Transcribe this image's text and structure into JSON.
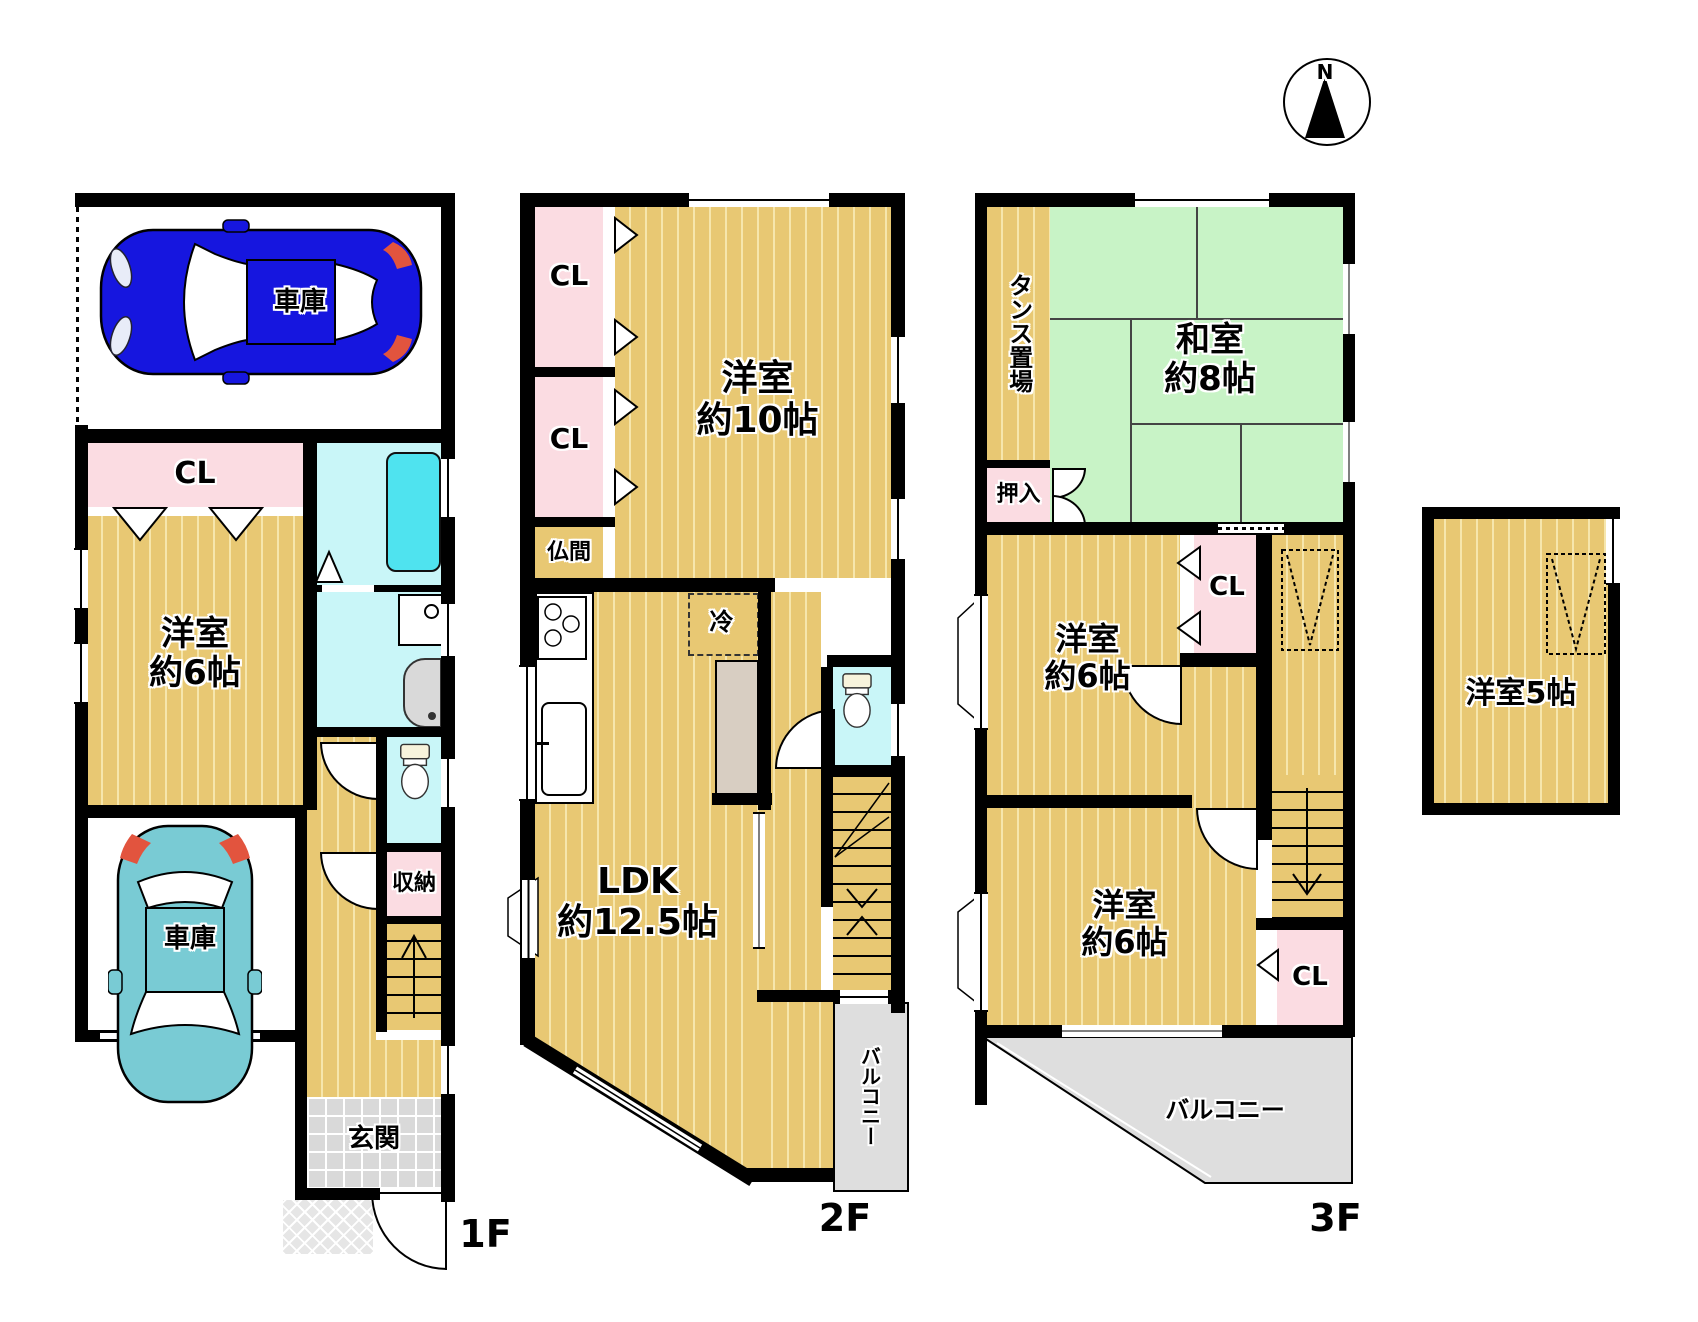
{
  "compass": {
    "north": "N"
  },
  "floor1": {
    "label": "1F",
    "garage_upper": "車庫",
    "garage_lower": "車庫",
    "closet": "CL",
    "western_room": "洋室\n約6帖",
    "storage": "収納",
    "entrance": "玄関"
  },
  "floor2": {
    "label": "2F",
    "closet_upper": "CL",
    "closet_lower": "CL",
    "butsuma": "仏間",
    "western_room": "洋室\n約10帖",
    "refrigerator": "冷",
    "ldk": "LDK\n約12.5帖",
    "balcony": "バルコニー"
  },
  "floor3": {
    "label": "3F",
    "tansu_space": "タンス置場",
    "japanese_room": "和室\n約8帖",
    "oshiire": "押入",
    "closet_a": "CL",
    "western_room_upper": "洋室\n約6帖",
    "western_room_lower": "洋室\n約6帖",
    "closet_b": "CL",
    "balcony": "バルコニー"
  },
  "annex": {
    "western_room": "洋室5帖"
  },
  "colors": {
    "wall": "#000000",
    "wood_floor": "#e8c873",
    "tatami_green": "#c8f3c6",
    "closet_pink": "#fbdce2",
    "wet_area_cyan": "#c9f6f8",
    "bathtub_cyan": "#4fe3ef",
    "balcony_gray": "#dedede",
    "car_blue": "#1616df",
    "car_teal": "#79cbd4"
  }
}
